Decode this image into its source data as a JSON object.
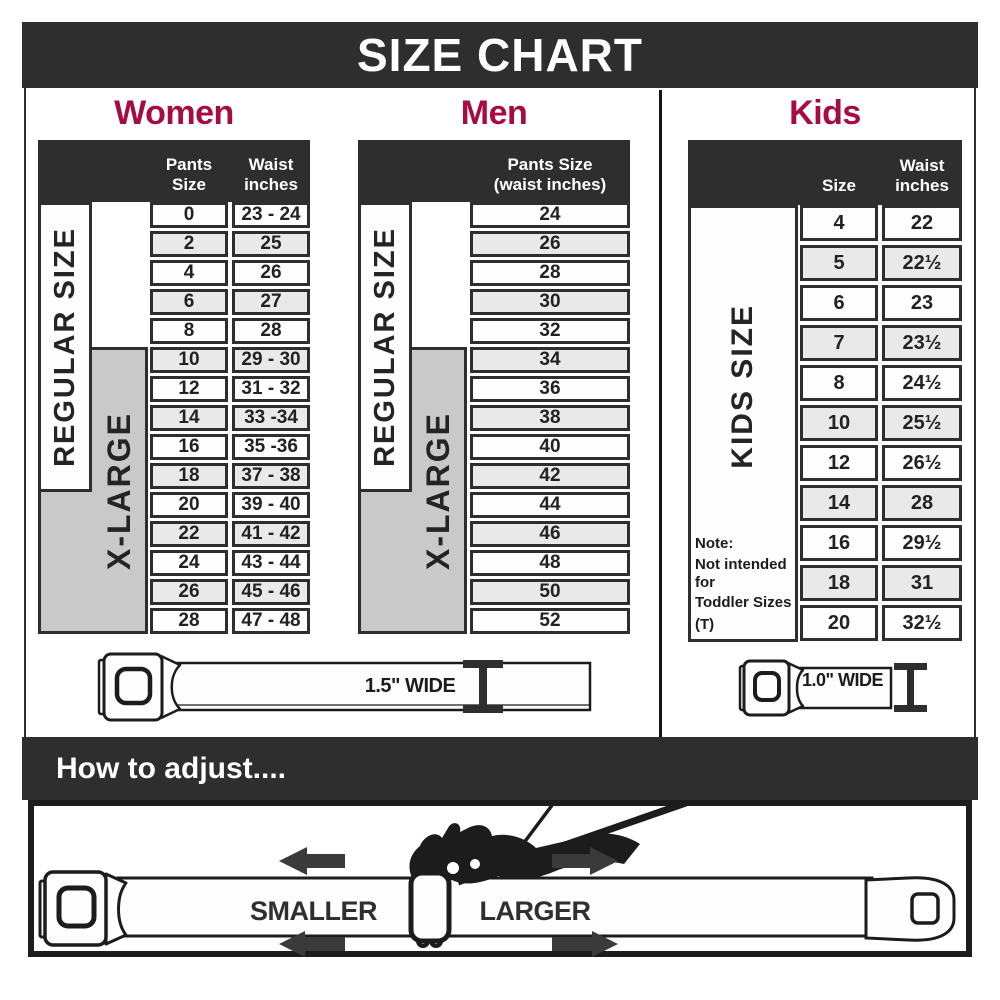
{
  "title": "SIZE CHART",
  "chart_data": [
    {
      "type": "table",
      "title": "Women",
      "columns": [
        "Pants Size",
        "Waist inches"
      ],
      "side_labels": [
        "REGULAR SIZE",
        "X-LARGE"
      ],
      "belt_width_label": "1.5\" WIDE",
      "rows": [
        [
          "0",
          "23 - 24"
        ],
        [
          "2",
          "25"
        ],
        [
          "4",
          "26"
        ],
        [
          "6",
          "27"
        ],
        [
          "8",
          "28"
        ],
        [
          "10",
          "29 - 30"
        ],
        [
          "12",
          "31 - 32"
        ],
        [
          "14",
          "33 -34"
        ],
        [
          "16",
          "35 -36"
        ],
        [
          "18",
          "37 - 38"
        ],
        [
          "20",
          "39 - 40"
        ],
        [
          "22",
          "41 - 42"
        ],
        [
          "24",
          "43 - 44"
        ],
        [
          "26",
          "45 - 46"
        ],
        [
          "28",
          "47 - 48"
        ]
      ]
    },
    {
      "type": "table",
      "title": "Men",
      "columns": [
        "Pants Size (waist inches)"
      ],
      "side_labels": [
        "REGULAR SIZE",
        "X-LARGE"
      ],
      "belt_width_label": "1.5\" WIDE",
      "rows": [
        [
          "24"
        ],
        [
          "26"
        ],
        [
          "28"
        ],
        [
          "30"
        ],
        [
          "32"
        ],
        [
          "34"
        ],
        [
          "36"
        ],
        [
          "38"
        ],
        [
          "40"
        ],
        [
          "42"
        ],
        [
          "44"
        ],
        [
          "46"
        ],
        [
          "48"
        ],
        [
          "50"
        ],
        [
          "52"
        ]
      ]
    },
    {
      "type": "table",
      "title": "Kids",
      "columns": [
        "Size",
        "Waist inches"
      ],
      "side_labels": [
        "KIDS SIZE"
      ],
      "note": "Note: Not intended for Toddler Sizes (T)",
      "belt_width_label": "1.0\" WIDE",
      "rows": [
        [
          "4",
          "22"
        ],
        [
          "5",
          "22½"
        ],
        [
          "6",
          "23"
        ],
        [
          "7",
          "23½"
        ],
        [
          "8",
          "24½"
        ],
        [
          "10",
          "25½"
        ],
        [
          "12",
          "26½"
        ],
        [
          "14",
          "28"
        ],
        [
          "16",
          "29½"
        ],
        [
          "18",
          "31"
        ],
        [
          "20",
          "32½"
        ]
      ]
    }
  ],
  "sections": {
    "women": {
      "col1_header": "Pants Size",
      "col2_header_l1": "Waist",
      "col2_header_l2": "inches",
      "regular": "REGULAR SIZE",
      "xlarge": "X-LARGE",
      "belt": "1.5\" WIDE"
    },
    "men": {
      "header_l1": "Pants Size",
      "header_l2": "(waist inches)",
      "regular": "REGULAR SIZE",
      "xlarge": "X-LARGE"
    },
    "kids": {
      "col1_header": "Size",
      "col2_header_l1": "Waist",
      "col2_header_l2": "inches",
      "side": "KIDS SIZE",
      "note1": "Note:",
      "note2": "Not intended for",
      "note3": "Toddler Sizes (T)",
      "belt": "1.0\" WIDE"
    }
  },
  "footer": {
    "title": "How to adjust....",
    "smaller": "SMALLER",
    "larger": "LARGER"
  },
  "colors": {
    "accent": "#a60c3f",
    "dark": "#2e2e2e",
    "xlarge_fill": "#c9c9c9",
    "row_alt": "#e9e9e9"
  }
}
